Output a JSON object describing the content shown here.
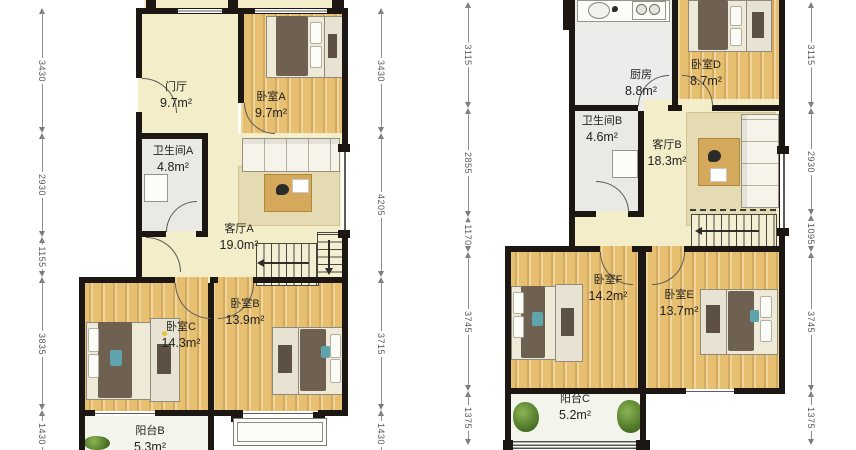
{
  "colors": {
    "wall": "#1c1712",
    "wood_floor": "#e7bf70",
    "cream_floor": "#f4edc9",
    "tile_floor": "#e9e9e5",
    "balcony_floor": "#f3f5ec",
    "dim_text": "#5a5a5a"
  },
  "left_plan": {
    "rooms": {
      "hall": {
        "name": "门厅",
        "area": "9.7m²"
      },
      "bedroom_a": {
        "name": "卧室A",
        "area": "9.7m²"
      },
      "bathroom_a": {
        "name": "卫生间A",
        "area": "4.8m²"
      },
      "living_a": {
        "name": "客厅A",
        "area": "19.0m²"
      },
      "bedroom_b": {
        "name": "卧室B",
        "area": "13.9m²"
      },
      "bedroom_c": {
        "name": "卧室C",
        "area": "14.3m²"
      },
      "balcony_b": {
        "name": "阳台B",
        "area": "5.3m²"
      }
    },
    "dims_left": [
      "3430",
      "2930",
      "1155",
      "3835",
      "1430"
    ],
    "dims_right": [
      "3430",
      "4205",
      "3715",
      "1430"
    ]
  },
  "right_plan": {
    "rooms": {
      "kitchen": {
        "name": "厨房",
        "area": "8.8m²"
      },
      "bedroom_d": {
        "name": "卧室D",
        "area": "8.7m²"
      },
      "bathroom_b": {
        "name": "卫生间B",
        "area": "4.6m²"
      },
      "living_b": {
        "name": "客厅B",
        "area": "18.3m²"
      },
      "bedroom_f": {
        "name": "卧室F",
        "area": "14.2m²"
      },
      "bedroom_e": {
        "name": "卧室E",
        "area": "13.7m²"
      },
      "balcony_c": {
        "name": "阳台C",
        "area": "5.2m²"
      }
    },
    "dims_left": [
      "3115",
      "2855",
      "1170",
      "3745",
      "1375"
    ],
    "dims_right": [
      "3115",
      "2930",
      "1095",
      "3745",
      "1375"
    ]
  }
}
